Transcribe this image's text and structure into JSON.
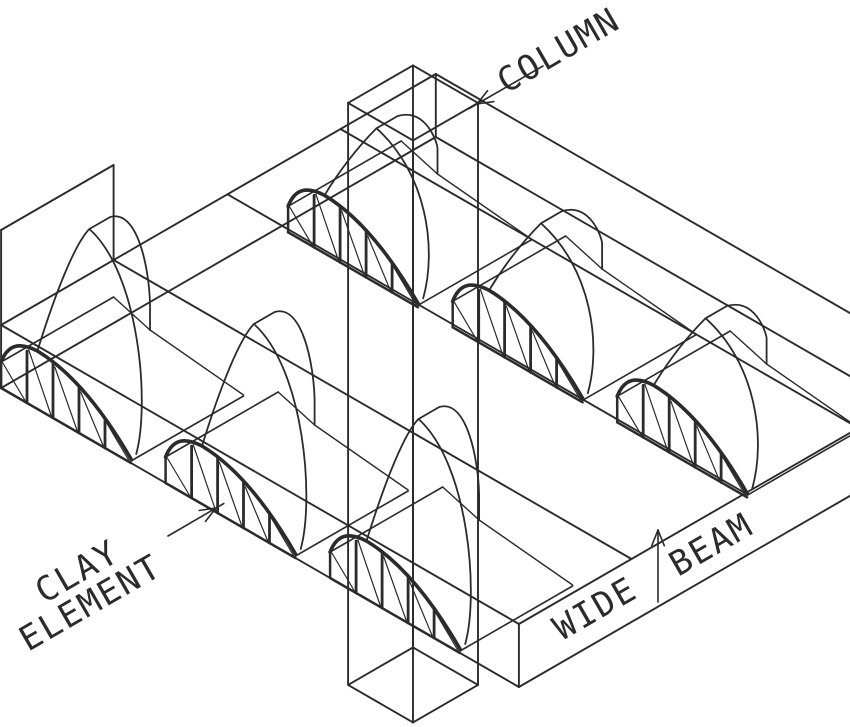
{
  "figure": {
    "title": "Wide-beam floor system isometric drawing",
    "background_color": "#ffffff",
    "line_color": "#2b2b2b"
  },
  "labels": {
    "column": "COLUMN",
    "clay_element_line1": "CLAY",
    "clay_element_line2": "ELEMENT",
    "wide_beam_word1": "WIDE",
    "wide_beam_word2": "BEAM"
  },
  "components": {
    "clay_elements_visible": 6,
    "columns_visible": 1,
    "wide_beams_visible": 1
  }
}
